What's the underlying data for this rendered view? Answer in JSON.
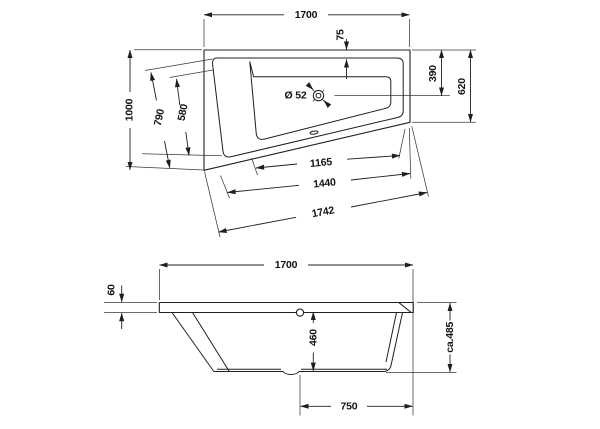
{
  "drawing": {
    "title_hint": "bathtub technical dimension drawing",
    "colors": {
      "line": "#1f1f1f",
      "background": "#ffffff"
    },
    "labels": {
      "top": {
        "width": "1700",
        "rim": "75",
        "drain_offset": "390",
        "right_side": "620",
        "left_side": "1000",
        "seat_diag": "790",
        "basin_diag": "580",
        "drain": "Ø 52",
        "inner_bottom": "1165",
        "outer_bottom": "1440",
        "total_diag": "1742"
      },
      "side": {
        "width": "1700",
        "rim_thickness": "60",
        "depth": "460",
        "height": "ca.485",
        "drain_to_end": "750"
      }
    }
  }
}
